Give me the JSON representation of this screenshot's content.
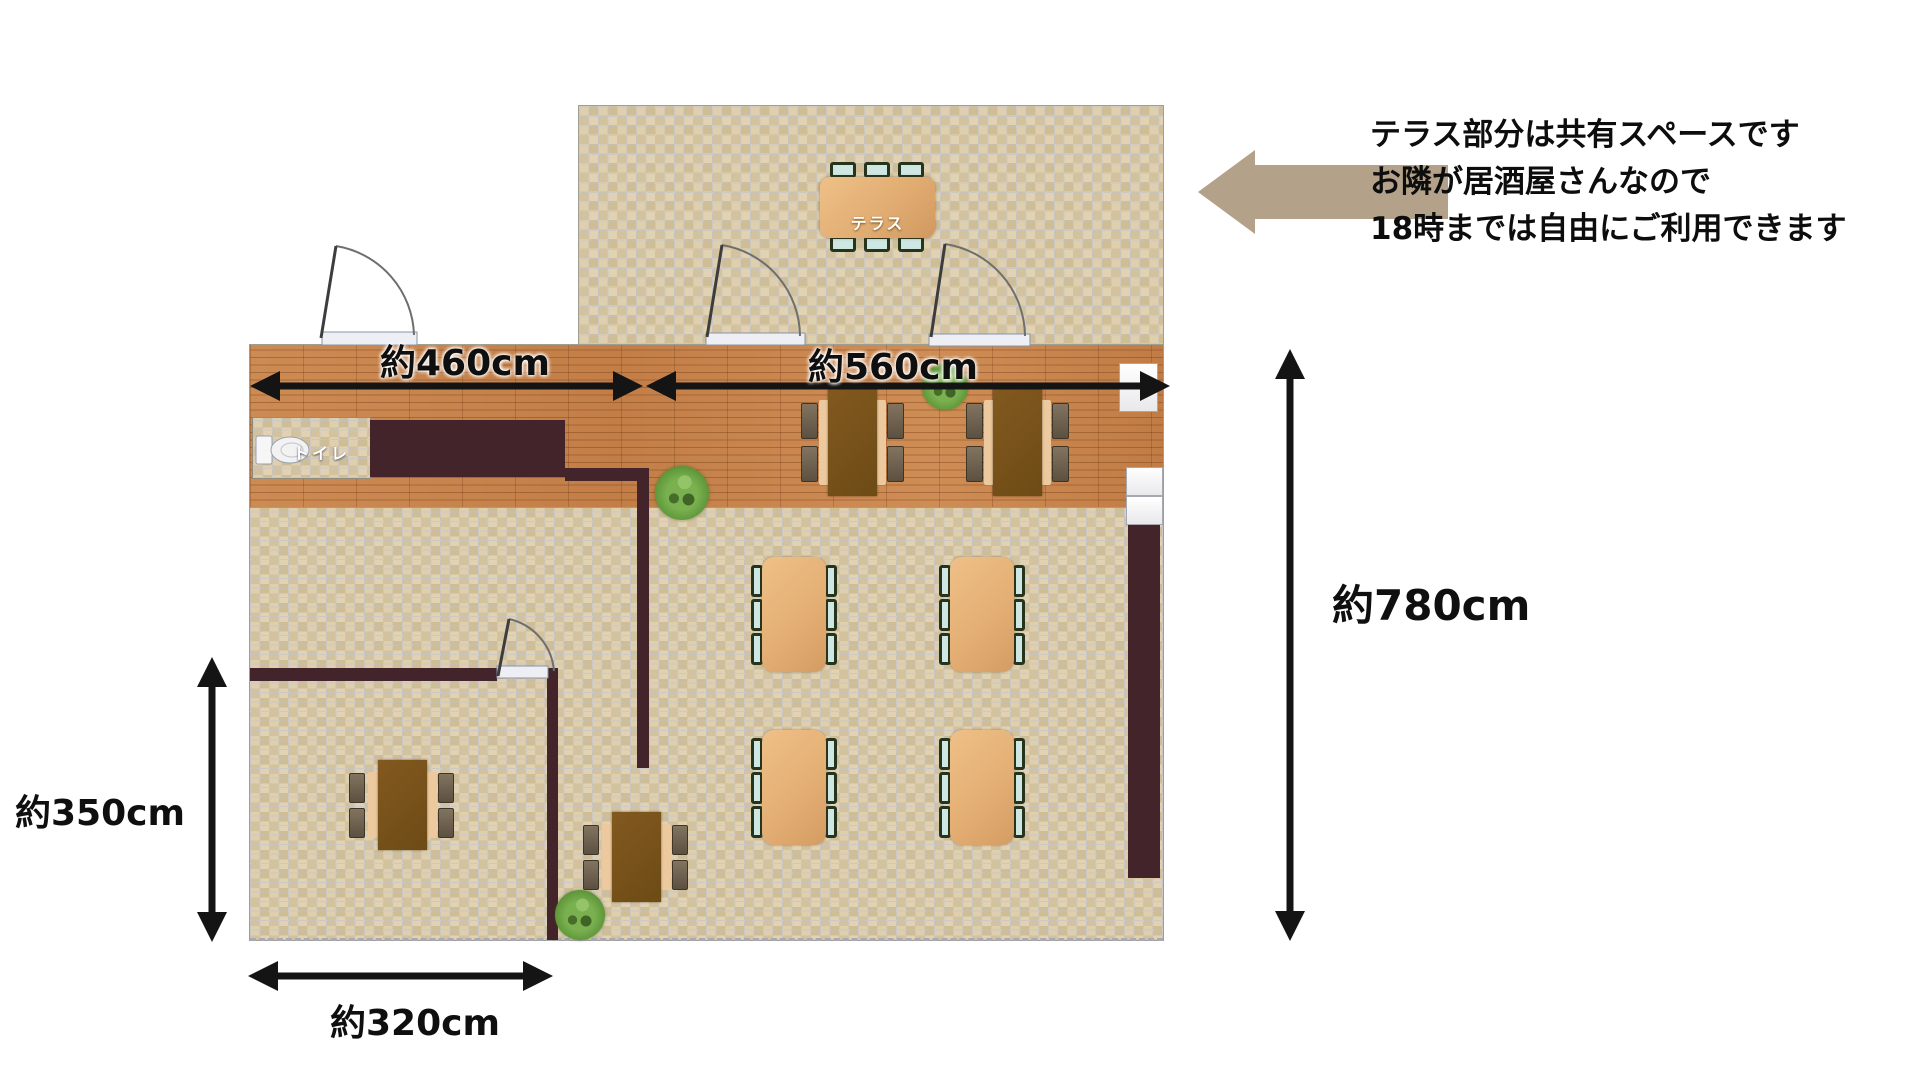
{
  "annotation": {
    "lines": [
      "テラス部分は共有スペースです",
      "お隣が居酒屋さんなので",
      "18時までは自由にご利用できます"
    ],
    "arrow_color": "#b3a189"
  },
  "dimensions": {
    "top_left": "約460cm",
    "top_right": "約560cm",
    "right": "約780cm",
    "left": "約350cm",
    "bottom": "約320cm"
  },
  "labels": {
    "terrace_table": "テラス",
    "toilet": "トイレ"
  },
  "colors": {
    "tile_floor": "#d9c9a7",
    "wood_floor": "#c9854e",
    "wall": "#42242a",
    "table_light": "#e4af74",
    "table_dark": "#77521a",
    "chair_seat": "#cfe7e2",
    "dimension_text": "#0f0f0f",
    "annotation_arrow": "#b3a189"
  }
}
